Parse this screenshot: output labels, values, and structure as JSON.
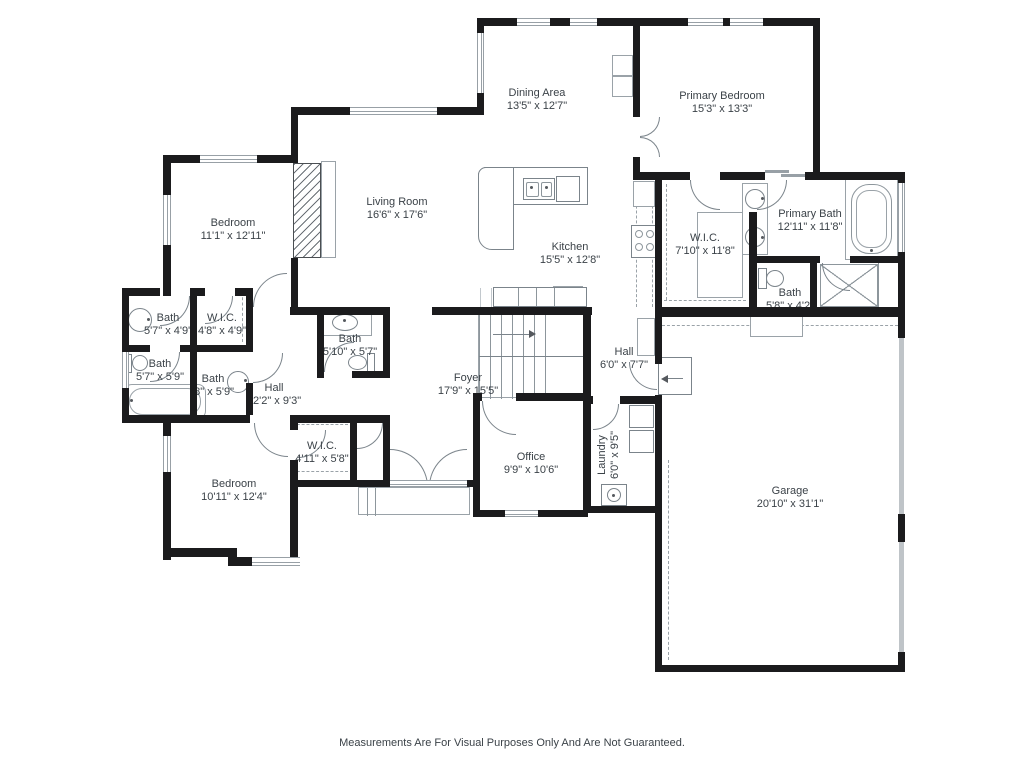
{
  "plan": {
    "footer_disclaimer": "Measurements Are For Visual Purposes Only And Are Not Guaranteed.",
    "colors": {
      "wall": "#1b1b1d",
      "fixture_line": "#8d969c",
      "text": "#3b4248",
      "garage_door_panel": "#bfc4c8",
      "background": "#ffffff"
    },
    "rooms": [
      {
        "name": "Dining Area",
        "dims": "13'5\" x 12'7\""
      },
      {
        "name": "Primary Bedroom",
        "dims": "15'3\" x 13'3\""
      },
      {
        "name": "Living Room",
        "dims": "16'6\" x 17'6\""
      },
      {
        "name": "Kitchen",
        "dims": "15'5\" x 12'8\""
      },
      {
        "name": "Bedroom",
        "dims": "11'1\" x 12'11\""
      },
      {
        "name": "W.I.C.",
        "dims": "7'10\" x 11'8\""
      },
      {
        "name": "Primary Bath",
        "dims": "12'11\" x 11'8\""
      },
      {
        "name": "Bath",
        "dims": "5'8\" x 4'2\""
      },
      {
        "name": "Bath",
        "dims": "5'7\" x 4'9\""
      },
      {
        "name": "W.I.C.",
        "dims": "4'8\" x 4'9\""
      },
      {
        "name": "Bath",
        "dims": "5'7\" x 5'9\""
      },
      {
        "name": "Bath",
        "dims": "'8\" x 5'9\""
      },
      {
        "name": "Bath",
        "dims": "5'10\" x 5'7\""
      },
      {
        "name": "Hall",
        "dims": "12'2\" x 9'3\""
      },
      {
        "name": "Foyer",
        "dims": "17'9\" x 15'5\""
      },
      {
        "name": "Hall",
        "dims": "6'0\" x 7'7\""
      },
      {
        "name": "W.I.C.",
        "dims": "4'11\" x 5'8\""
      },
      {
        "name": "Office",
        "dims": "9'9\" x 10'6\""
      },
      {
        "name": "Laundry",
        "dims": "6'0\" x 9'5\""
      },
      {
        "name": "Bedroom",
        "dims": "10'11\" x 12'4\""
      },
      {
        "name": "Garage",
        "dims": "20'10\" x 31'1\""
      }
    ]
  }
}
